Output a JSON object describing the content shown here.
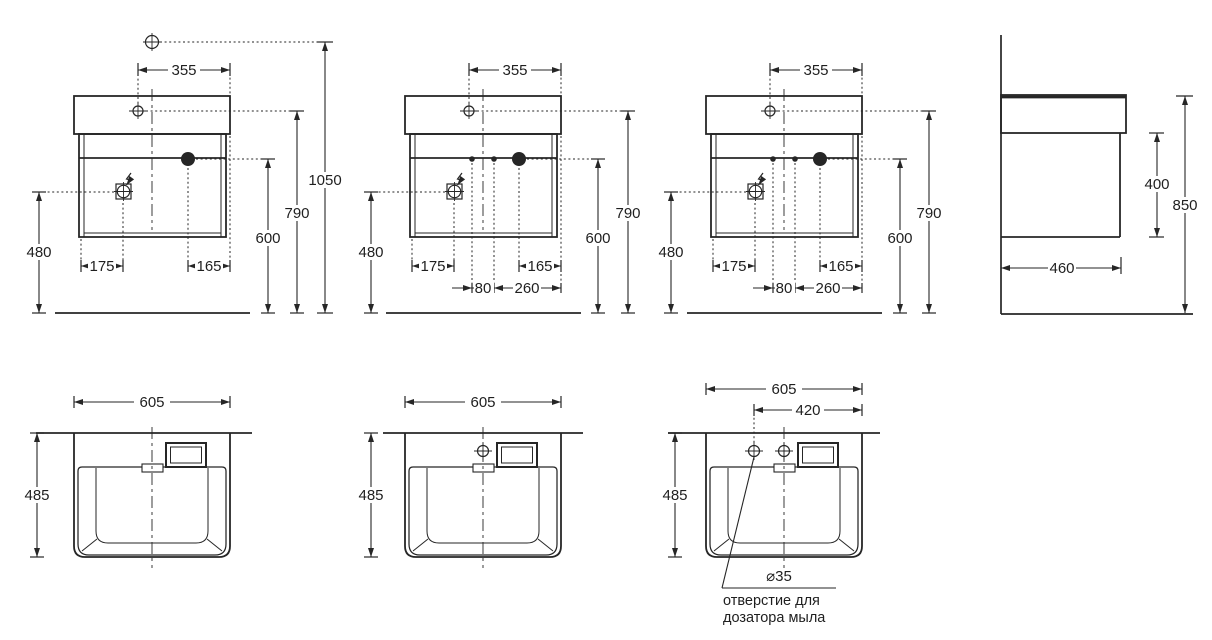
{
  "front_views": [
    {
      "top_width": "355",
      "overall_height": "1050",
      "deck_height": "790",
      "drain_height": "600",
      "socket_height": "480",
      "socket_offset": "175",
      "drain_offset": "165"
    },
    {
      "top_width": "355",
      "deck_height": "790",
      "drain_height": "600",
      "socket_height": "480",
      "socket_offset": "175",
      "drain_offset": "165",
      "hole_spacing": "80",
      "holes_to_edge": "260"
    },
    {
      "top_width": "355",
      "deck_height": "790",
      "drain_height": "600",
      "socket_height": "480",
      "socket_offset": "175",
      "drain_offset": "165",
      "hole_spacing": "80",
      "holes_to_edge": "260"
    }
  ],
  "side_view": {
    "cabinet_height": "400",
    "total_height": "850",
    "depth": "460"
  },
  "top_views": [
    {
      "width": "605",
      "depth": "485"
    },
    {
      "width": "605",
      "depth": "485"
    },
    {
      "width": "605",
      "depth": "485",
      "hole_offset": "420",
      "hole_diameter": "⌀35",
      "note_line1": "отверстие для",
      "note_line2": "дозатора мыла"
    }
  ],
  "colors": {
    "line": "#262626",
    "text": "#1f1f1f",
    "background": "#ffffff"
  }
}
